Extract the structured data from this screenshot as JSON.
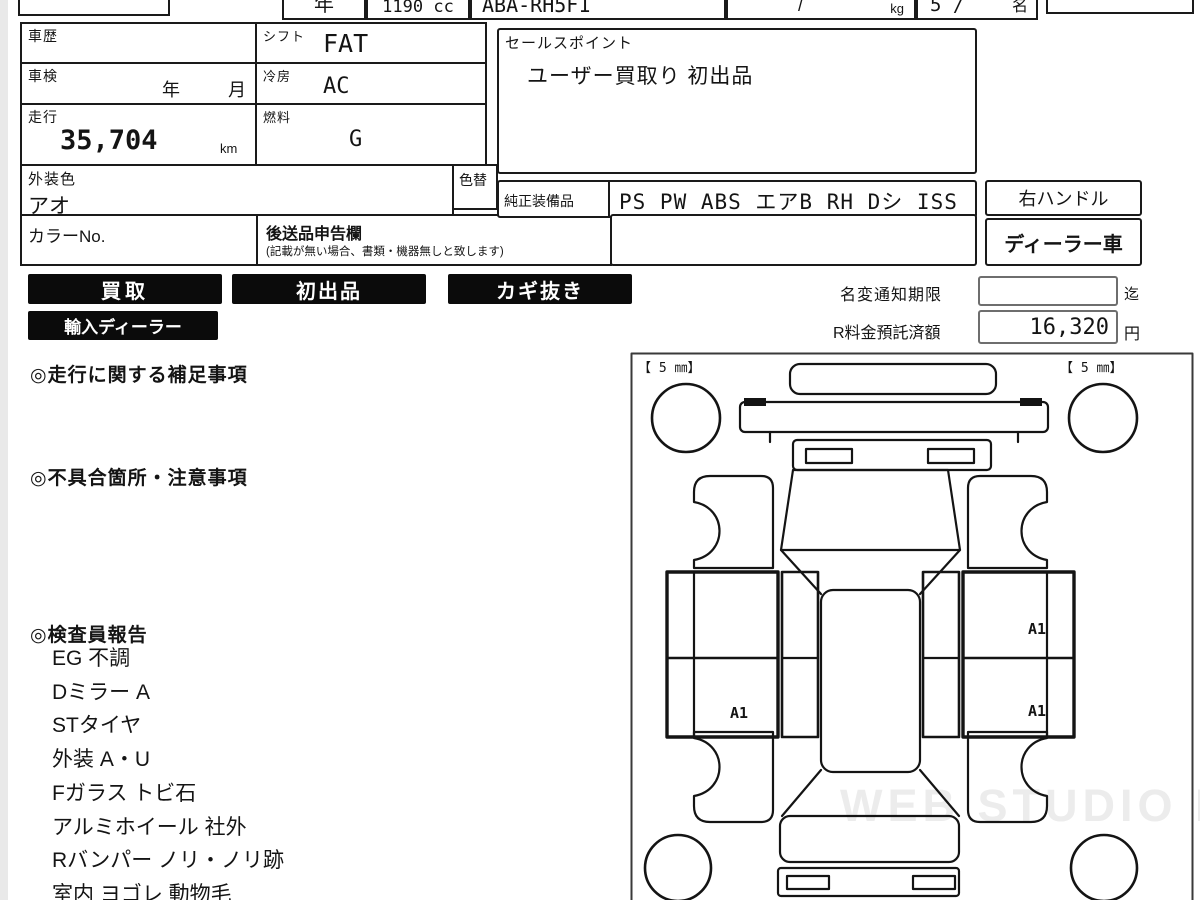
{
  "colors": {
    "ink": "#141414",
    "badge_bg": "#0b0b0b",
    "badge_text": "#ffffff",
    "watermark": "#ececec"
  },
  "top_strip": {
    "year": "年",
    "displacement": "1190 cc",
    "model_code": "ABA-RH5F1",
    "weight_slash": "/",
    "weight_unit": "kg",
    "capacity": "5 /",
    "capacity_unit": "名"
  },
  "info": {
    "history_label": "車歴",
    "shift_label": "シフト",
    "shift_value": "FAT",
    "inspection_label": "車検",
    "inspection_year": "年",
    "inspection_month": "月",
    "aircon_label": "冷房",
    "aircon_value": "AC",
    "mileage_label": "走行",
    "mileage_value": "35,704",
    "mileage_unit": "km",
    "fuel_label": "燃料",
    "fuel_value": "G",
    "exterior_color_label": "外装色",
    "exterior_color_value": "アオ",
    "color_change_label": "色替",
    "color_no_label": "カラーNo.",
    "later_items_label": "後送品申告欄",
    "later_items_note": "(記載が無い場合、書類・機器無しと致します)",
    "sales_point_label": "セールスポイント",
    "sales_point_value": "ユーザー買取り 初出品",
    "equipment_label": "純正装備品",
    "equipment_value": "PS PW ABS エアB RH Dシ ISS",
    "steering": "右ハンドル",
    "dealer_car": "ディーラー車"
  },
  "badges": [
    "買取",
    "初出品",
    "カギ抜き",
    "輸入ディーラー"
  ],
  "notice": {
    "name_change_label": "名変通知期限",
    "name_change_value": "",
    "name_change_suffix": "迄",
    "recycle_label": "R料金預託済額",
    "recycle_value": "16,320",
    "recycle_suffix": "円"
  },
  "sections": {
    "driving_notes_heading": "◎走行に関する補足事項",
    "defects_heading": "◎不具合箇所・注意事項",
    "inspector_heading": "◎検査員報告",
    "inspector_items": [
      "EG 不調",
      "Dミラー A",
      "STタイヤ",
      "外装 A・U",
      "Fガラス トビ石",
      "アルミホイール 社外",
      "Rバンパー ノリ・ノリ跡",
      "室内 ヨゴレ 動物毛"
    ]
  },
  "diagram": {
    "tread_left": "【 5 ㎜】",
    "tread_right": "【 5 ㎜】",
    "marks": [
      "A1",
      "A1",
      "A1"
    ],
    "watermark": "WEB STUDIO PRO"
  }
}
